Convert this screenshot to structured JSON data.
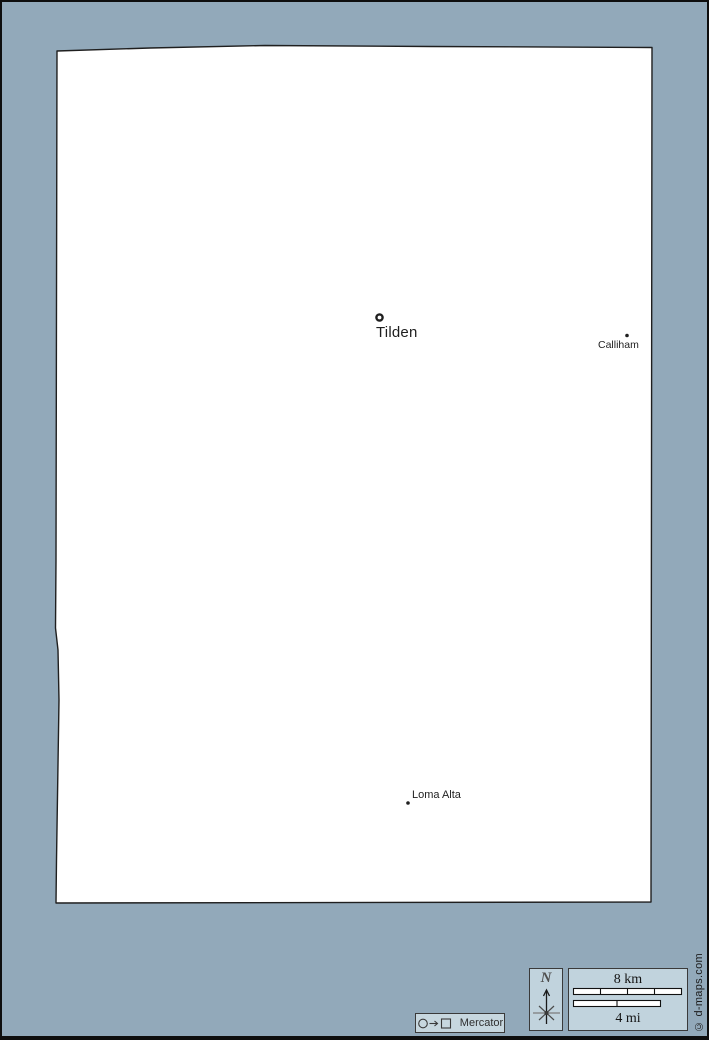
{
  "colors": {
    "background": "#92a9ba",
    "land": "#ffffff",
    "outline": "#1f1f1f",
    "panel_bg": "#c1d3dd",
    "panel_border": "#3a3a3a",
    "text": "#1f1f1f"
  },
  "map": {
    "places": [
      {
        "name": "Tilden",
        "marker": "county-seat-ring"
      },
      {
        "name": "Calliham",
        "marker": "dot"
      },
      {
        "name": "Loma Alta",
        "marker": "dot"
      }
    ]
  },
  "compass": {
    "north_label": "N"
  },
  "scale_bar": {
    "top_label": "8 km",
    "bottom_label": "4 mi"
  },
  "projection_legend": {
    "symbols": "circle-arrow-square",
    "label": "Mercator"
  },
  "credit": "© d-maps.com"
}
